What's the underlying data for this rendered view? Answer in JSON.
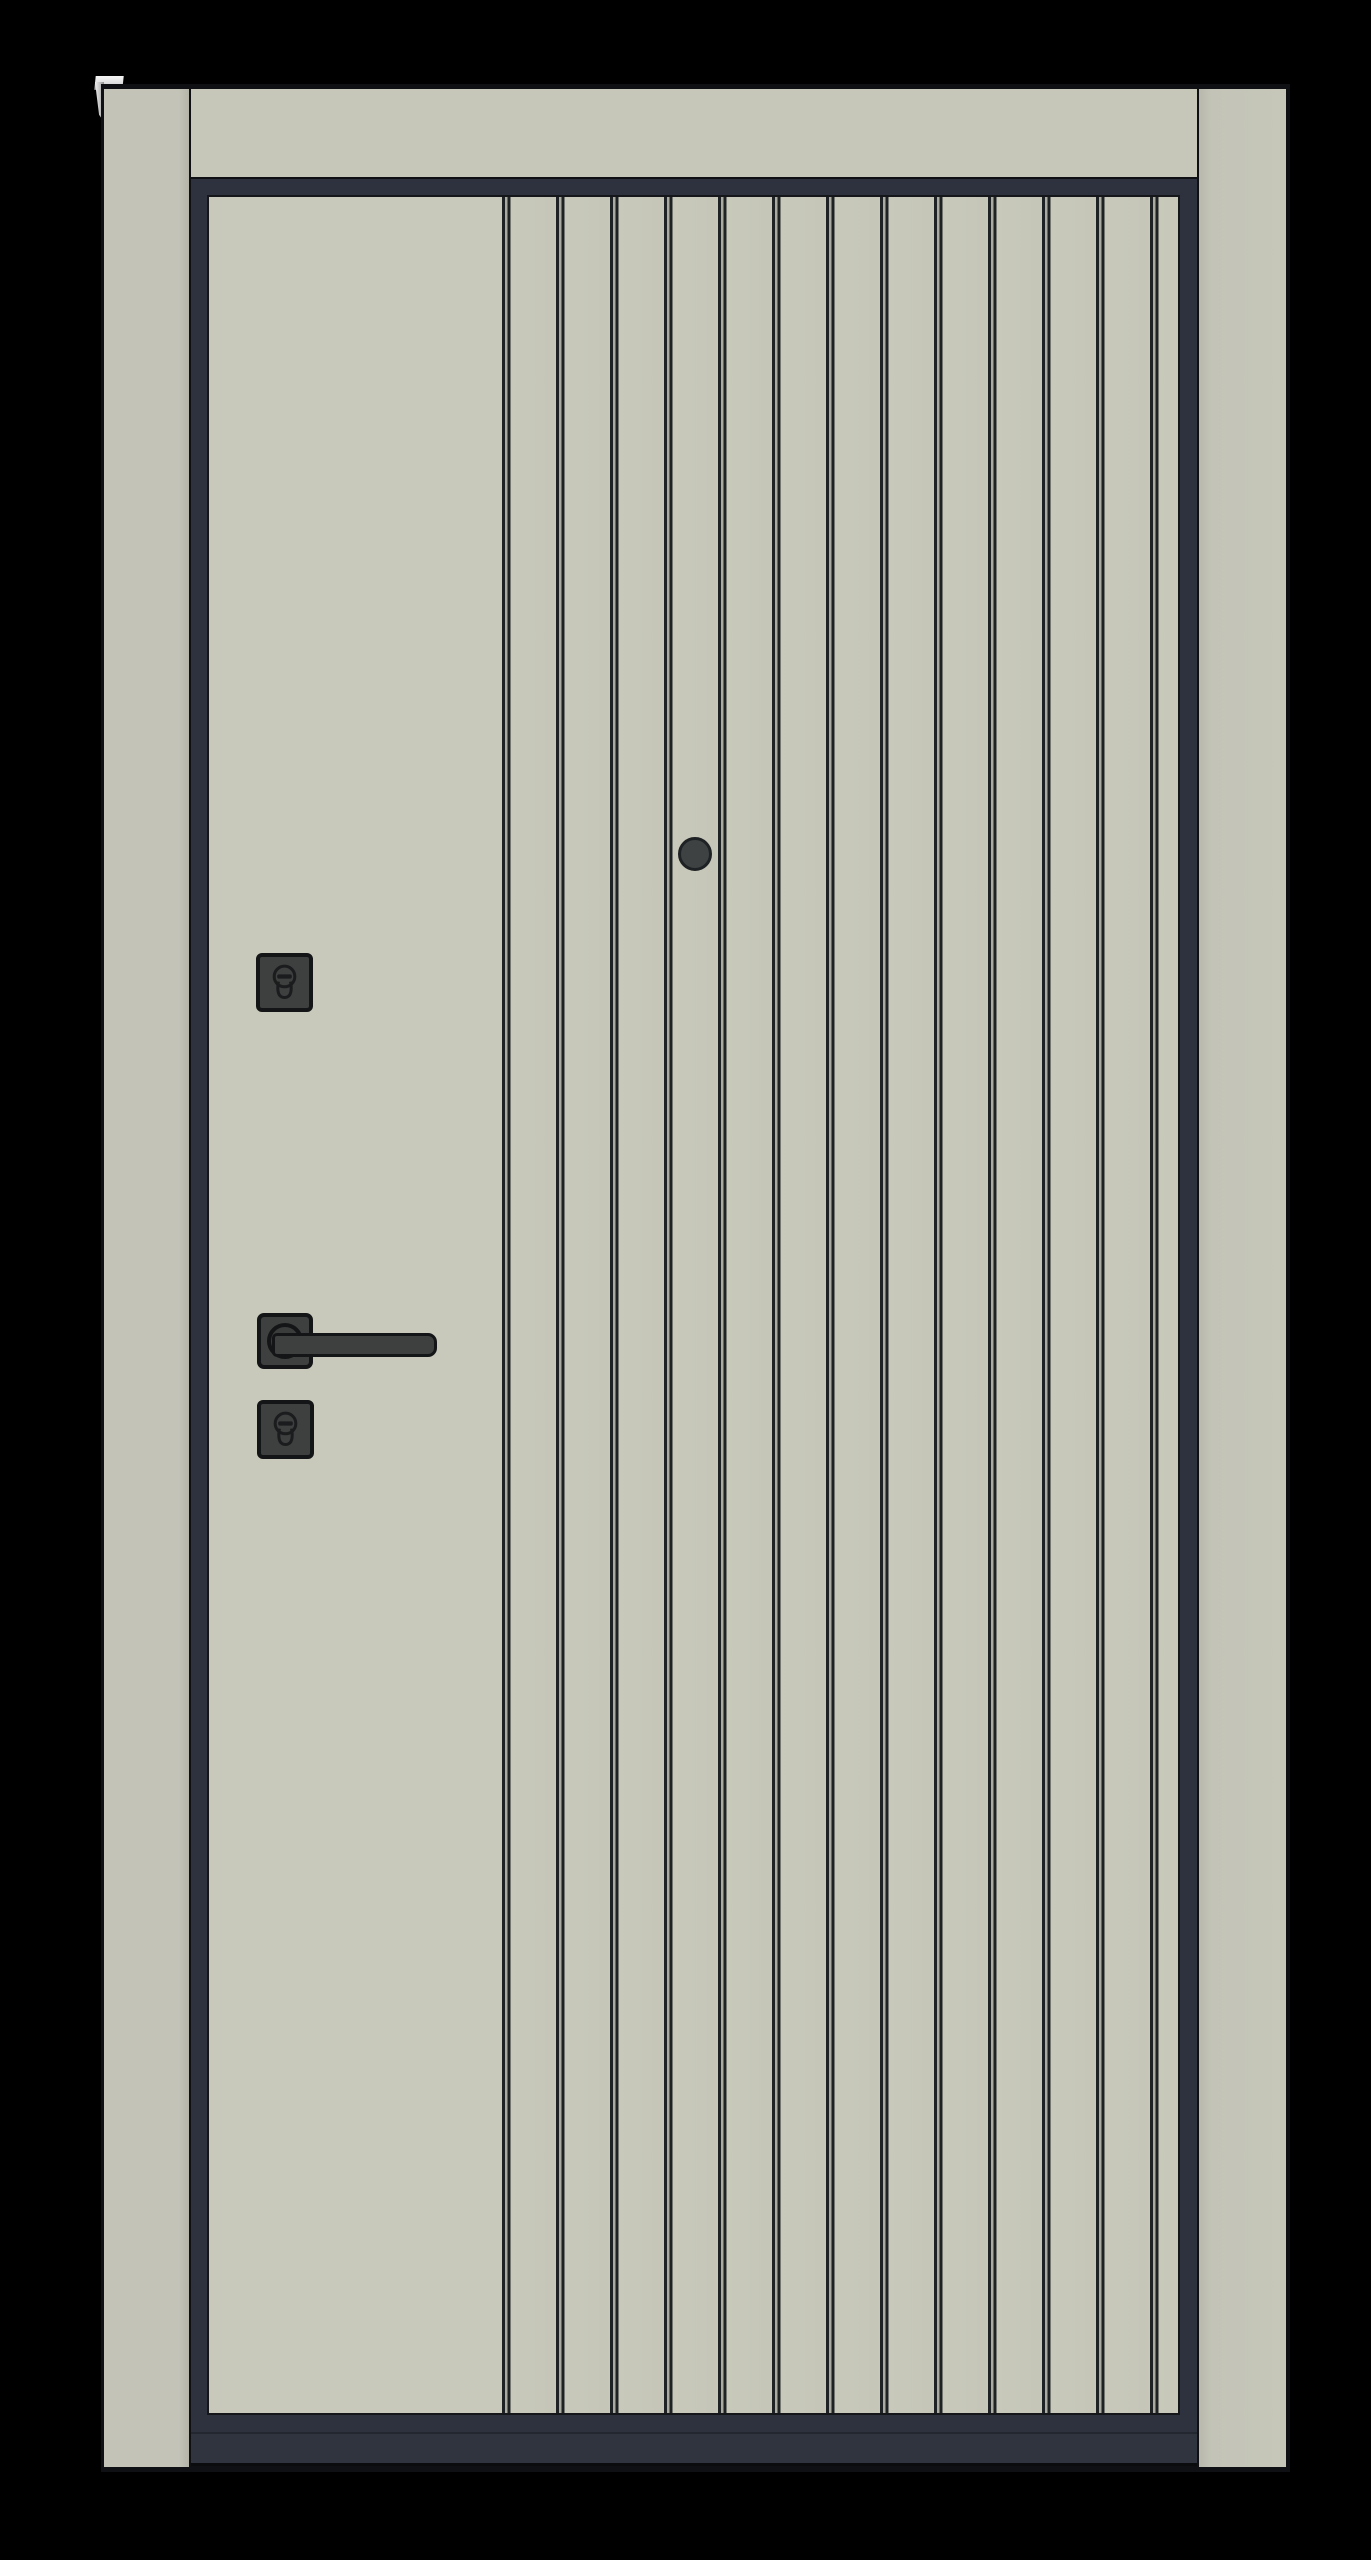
{
  "scene": {
    "subject": "modern entry door, closed, front view product render",
    "background_color": "#000000"
  },
  "door": {
    "colors": {
      "background": "#000000",
      "outline": "#0e1013",
      "frame": "#c3c4b7",
      "header": "#c6c7b9",
      "leaf": "#c8c9bb",
      "groove-gap": "#aaaba0",
      "groove-line": "#1f2225",
      "seal": "#2d323e",
      "threshold": "#30343e",
      "hw": "#3e3f3f",
      "hw-outline": "#141516",
      "peephole": "#3e4243",
      "bracket": "#ececec"
    },
    "groove_pair_count": 13,
    "panel_style": "flat panel on hinge side, vertical double-groove slats on lock side",
    "hardware": {
      "peephole": "peephole-viewer",
      "upper_lock": "cylinder-keyhole-escutcheon",
      "handle": "lever-handle-on-square-rosette",
      "lower_lock": "cylinder-keyhole-escutcheon"
    }
  }
}
